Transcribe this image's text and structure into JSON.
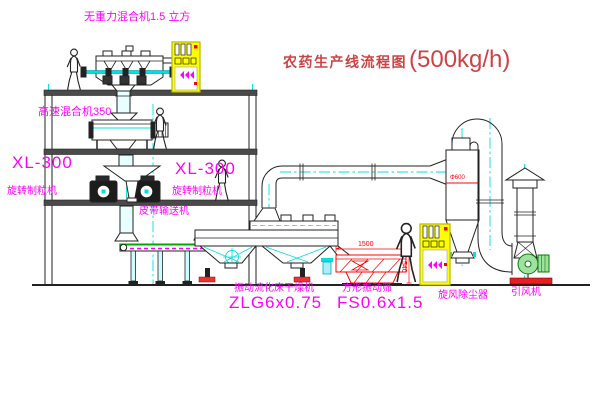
{
  "title": {
    "text": "农药生产线流程图",
    "capacity": "(500kg/h)"
  },
  "labels": {
    "gravity_mixer": "无重力混合机1.5 立方",
    "high_speed_mixer": "高速混合机350",
    "granulator_left": {
      "model": "XL-300",
      "name": "旋转制粒机"
    },
    "granulator_right": {
      "model": "XL-300",
      "name": "旋转制粒机"
    },
    "belt_conveyor": "皮带输送机",
    "fluid_bed_dryer": {
      "name": "振动流化床干燥机",
      "model": "ZLG6x0.75"
    },
    "vibrating_sieve": {
      "name": "方形振动筛",
      "model": "FS0.6x1.5"
    },
    "cyclone": "旋风除尘器",
    "induced_draft_fan": "引风机"
  },
  "dimensions": {
    "sieve_length": "1500",
    "sieve_height": "540",
    "cyclone_diameter": "Φ600"
  },
  "colors": {
    "label_magenta": "#ff00ff",
    "title_red": "#cc4444",
    "dimension_red": "#ff0000",
    "centerline_cyan": "#00e0e0",
    "cabinet_yellow": "#ffff00",
    "machine_green": "#00a800",
    "sieve_red": "#ff0000"
  }
}
